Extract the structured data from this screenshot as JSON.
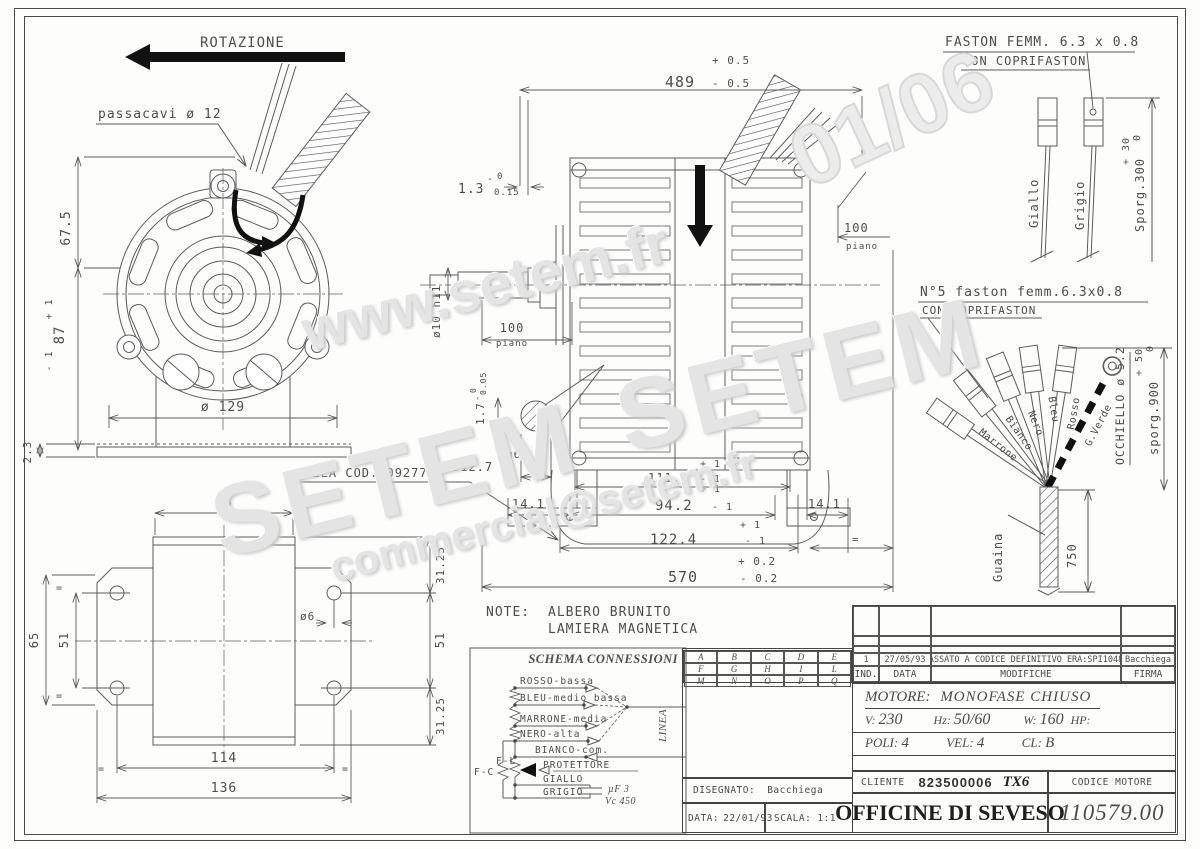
{
  "watermarks": {
    "www": "www.setem.fr",
    "setem": "SETEM",
    "email": "commercial@setem.fr",
    "handwriting": "01/06"
  },
  "front": {
    "rotation": "ROTAZIONE",
    "passacavi": "passacavi ø 12",
    "dim_h_top": "67.5",
    "dim_h_mid": "87",
    "tol_p1": "+ 1",
    "tol_m1": "- 1",
    "dia": "ø 129",
    "dim_base": "2.3"
  },
  "side": {
    "dim_489": "489",
    "tol_489p": "+ 0.5",
    "tol_489m": "- 0.5",
    "dim_13": "1.3",
    "minus": "-",
    "tol_13_top": "0",
    "tol_13_bot": "0.15",
    "dim_100": "100",
    "piano": "piano",
    "shaft": "ø10 h11",
    "dim_17": "1.7",
    "tol_17_top": "0",
    "tol_17_bot": "0.05",
    "detail_dia": "ø12.7",
    "fit": "g6",
    "culla": "CULLA COD.30927702",
    "dim_1112": "111.2",
    "dim_942": "94.2",
    "dim_1224": "122.4",
    "dim_570": "570",
    "tol_570p": "+ 0.2",
    "tol_570m": "- 0.2",
    "tol_p1": "+ 1",
    "tol_m1": "- 1",
    "dim_141": "14.1",
    "eq": "="
  },
  "bottom_view": {
    "dim_75": "75",
    "dim_65": "65",
    "dim_51": "51",
    "dim_3125": "31.25",
    "dim_114": "114",
    "dim_136": "136",
    "hole": "ø6",
    "eq": "="
  },
  "note": {
    "label": "NOTE:",
    "line1": "ALBERO BRUNITO",
    "line2": "LAMIERA MAGNETICA"
  },
  "faston1": {
    "title": "FASTON FEMM. 6.3 x 0.8",
    "sub": "CON COPRIFASTON",
    "giallo": "Giallo",
    "grigio": "Grigio",
    "sporg": "Sporg.300",
    "tol_p": "+ 30",
    "tol_0": "0"
  },
  "faston2": {
    "title": "N°5 faston femm.6.3x0.8",
    "sub": "CON COPRIFASTON",
    "w1": "Marrone",
    "w2": "Bianco",
    "w3": "Nero",
    "w4": "Bleu",
    "w5": "Rosso",
    "w6": "G.Verde",
    "occhiello": "OCCHIELLO ø 5.2",
    "sporg": "sporg.900",
    "tol_p": "+ 50",
    "tol_0": "0",
    "guaina": "Guaina",
    "dim_750": "750"
  },
  "schema": {
    "title": "SCHEMA CONNESSIONI",
    "w_rosso": "ROSSO-bassa",
    "w_bleu": "BLEU-medio bassa",
    "w_marrone": "MARRONE-media",
    "w_nero": "NERO-alta",
    "w_bianco": "BIANCO-com.",
    "w_prot": "PROTETTORE",
    "w_giallo": "GIALLO",
    "w_grigio": "GRIGIO",
    "fc": "F-C",
    "fl": "F-L",
    "cap1": "µF 3",
    "cap2": "Vc 450",
    "linea": "LINEA"
  },
  "grid": {
    "r1": [
      "A",
      "B",
      "C",
      "D",
      "E"
    ],
    "r2": [
      "F",
      "G",
      "H",
      "I",
      "L"
    ],
    "r3": [
      "M",
      "N",
      "O",
      "P",
      "Q"
    ]
  },
  "revision": {
    "ind": "1",
    "date": "27/05/93",
    "mod": "PASSATO A CODICE DEFINITIVO ERA:SPI10485",
    "firma": "Bacchiega",
    "h_ind": "IND.",
    "h_data": "DATA",
    "h_mod": "MODIFICHE",
    "h_firma": "FIRMA"
  },
  "titleblock": {
    "motore_label": "MOTORE:",
    "motore": "MONOFASE CHIUSO",
    "v_label": "V:",
    "v": "230",
    "hz_label": "Hz:",
    "hz": "50/60",
    "w_label": "W:",
    "w": "160",
    "hp_label": "HP:",
    "poli_label": "POLI:",
    "poli": "4",
    "vel_label": "VEL:",
    "vel": "4",
    "cl_label": "CL:",
    "cl": "B",
    "cliente_label": "CLIENTE",
    "cliente": "823500006",
    "tx": "TX6",
    "codice_label": "CODICE MOTORE",
    "company": "OFFICINE DI SEVESO",
    "codice": "110579.00",
    "disegnato_label": "DISEGNATO:",
    "disegnato": "Bacchiega",
    "data_label": "DATA:",
    "data": "22/01/93",
    "scala_label": "SCALA:",
    "scala": "1:1"
  }
}
